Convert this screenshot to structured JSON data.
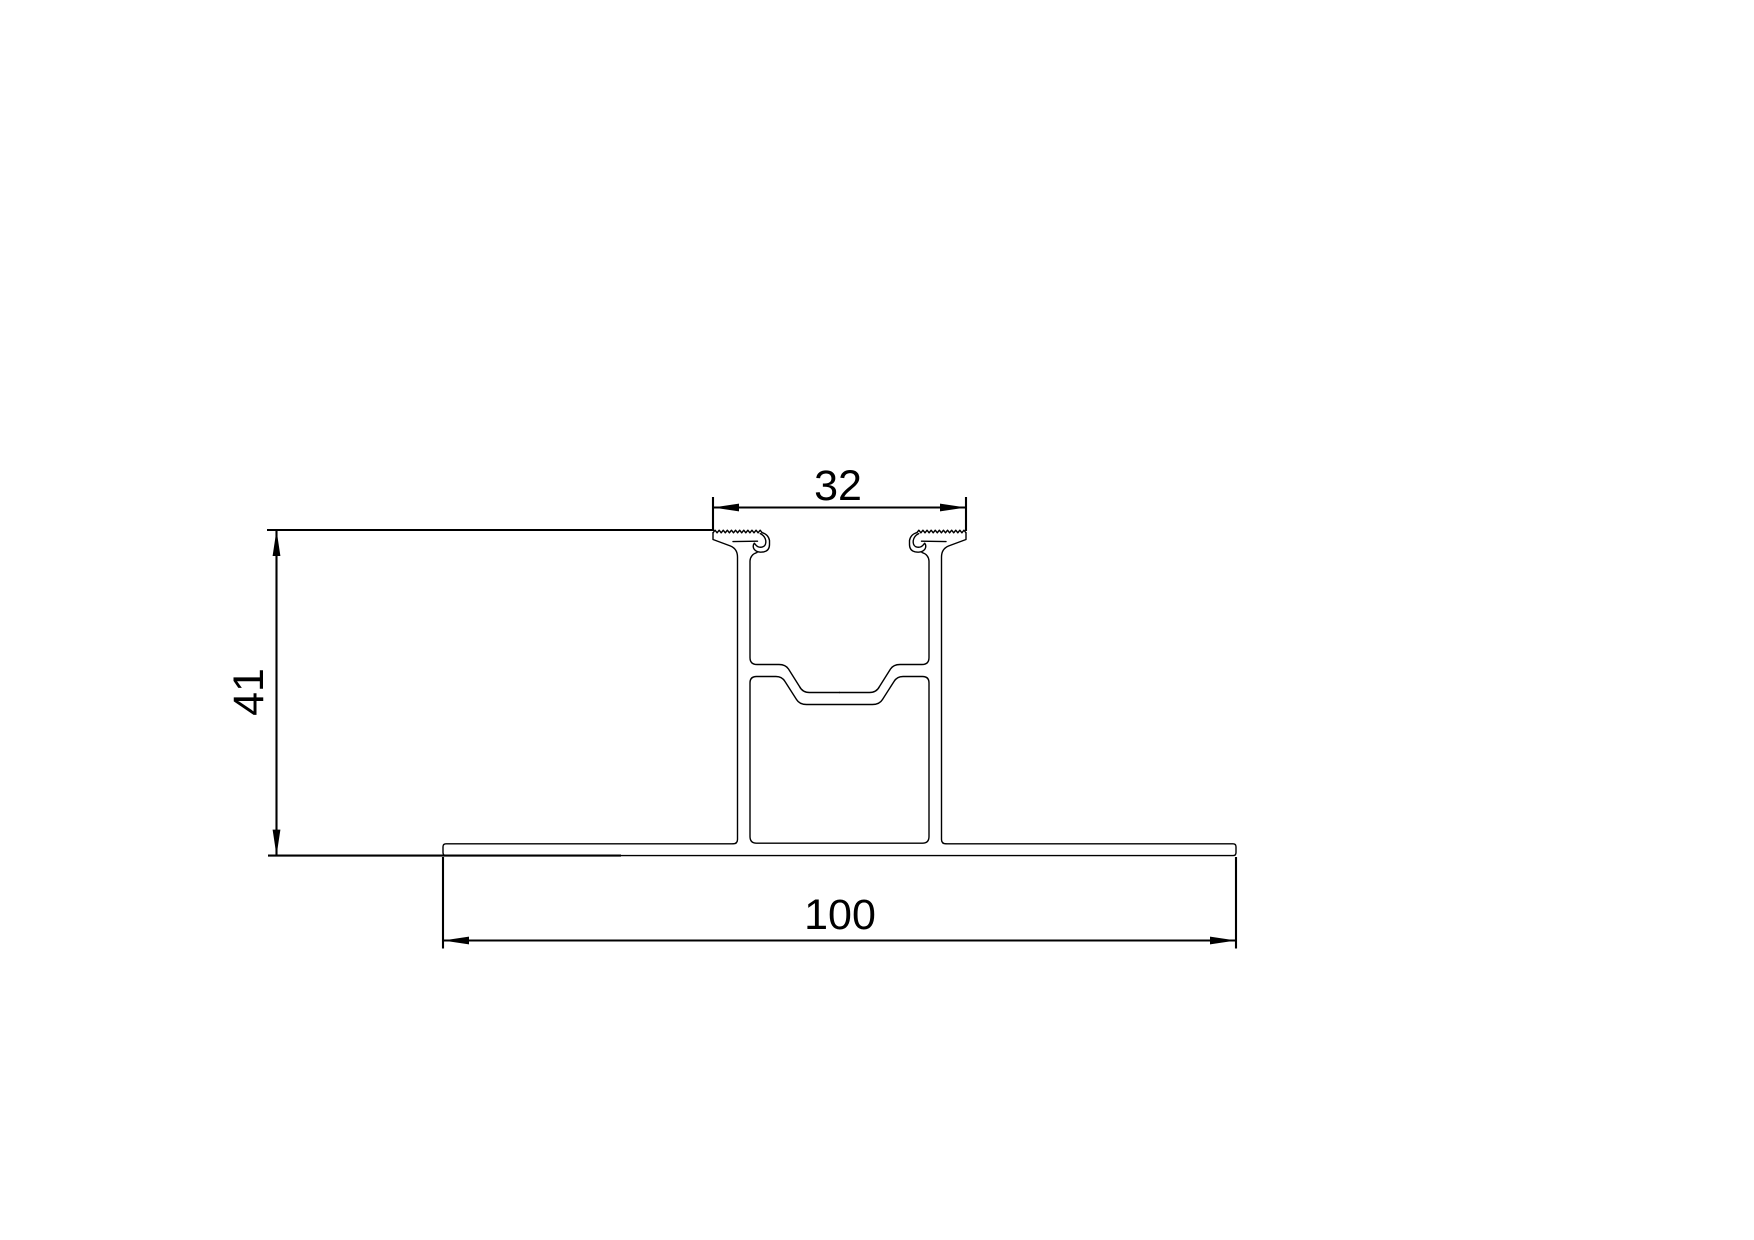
{
  "page": {
    "background": "#ffffff"
  },
  "drawing": {
    "kind": "extrusion-profile-cross-section",
    "stroke_color": "#000000",
    "dimensions": [
      {
        "id": "top-width",
        "label": "32",
        "orientation": "horizontal",
        "position": "top"
      },
      {
        "id": "overall-height",
        "label": "41",
        "orientation": "vertical",
        "position": "left"
      },
      {
        "id": "base-width",
        "label": "100",
        "orientation": "horizontal",
        "position": "bottom"
      }
    ]
  }
}
